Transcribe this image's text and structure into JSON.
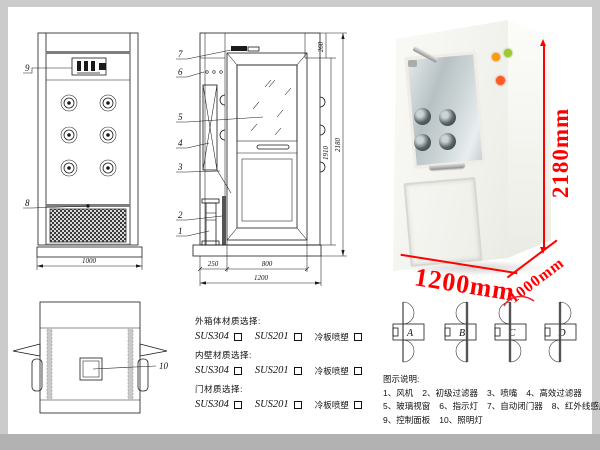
{
  "colors": {
    "accent_red": "#ff0000",
    "line": "#1a1a1a",
    "frame_gray": "#cbcbcb",
    "bottom_bar": "#b2b2b2"
  },
  "front_view": {
    "callout_9": "9",
    "callout_8": "8",
    "width_dim": "1000"
  },
  "side_view": {
    "callout_7": "7",
    "callout_6": "6",
    "callout_5": "5",
    "callout_4": "4",
    "callout_3": "3",
    "callout_2": "2",
    "callout_1": "1",
    "dim_top": "260",
    "dim_inner": "1910",
    "dim_total": "2180",
    "dim_side": "250",
    "dim_door": "800",
    "dim_depth": "1200"
  },
  "top_view": {
    "callout_10": "10"
  },
  "photo": {
    "dim_height": "2180mm",
    "dim_width": "1200mm",
    "dim_depth": "1000mm"
  },
  "materials": {
    "groups": [
      {
        "title": "外箱体材质选择:",
        "opt1": "SUS304",
        "opt2": "SUS201",
        "opt3": "冷板喷塑"
      },
      {
        "title": "内壁材质选择:",
        "opt1": "SUS304",
        "opt2": "SUS201",
        "opt3": "冷板喷塑"
      },
      {
        "title": "门材质选择:",
        "opt1": "SUS304",
        "opt2": "SUS201",
        "opt3": "冷板喷塑"
      }
    ]
  },
  "door_options": {
    "a": "A",
    "b": "B",
    "c": "C",
    "d": "D"
  },
  "legend": {
    "title": "图示说明:",
    "row1": [
      "1、风机",
      "2、初级过滤器",
      "3、喷嘴",
      "4、高效过滤器"
    ],
    "row2": [
      "5、玻璃视窗",
      "6、指示灯",
      "7、自动闭门器",
      "8、红外线感应器"
    ],
    "row3": [
      "9、控制面板",
      "10、照明灯"
    ]
  }
}
